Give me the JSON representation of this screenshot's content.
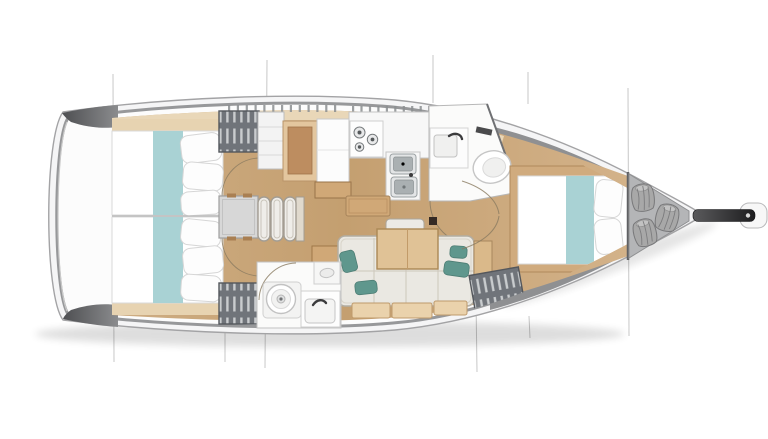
{
  "meta": {
    "title": "Sailboat interior layout floor plan, top view, bow pointing right",
    "figure_type": "boat-floor-plan",
    "orientation": "bow-right"
  },
  "palette": {
    "background": "#ffffff",
    "hull_fill": "#f5f5f6",
    "hull_outline": "#a3a3a5",
    "deck_white": "#fcfcfc",
    "gunwale": "#97989a",
    "stern_wedge_dark": "#515255",
    "stern_wedge_light": "#8b8c8e",
    "bow_band": "#8f9092",
    "floor_wood": "#c9a87c",
    "floor_wood_light": "#d8bc94",
    "deck_band": "#e9d7b8",
    "tick": "#8b8e90",
    "bed_white": "#ffffff",
    "bed_edge": "#d9d9d9",
    "bed_teal": "#a9d2d4",
    "pillow_white": "#fdfdfd",
    "pillow_edge": "#d6d6d6",
    "wardrobe_dark": "#70747a",
    "wardrobe_hanger": "#c9ccce",
    "wardrobe_edge": "#54575c",
    "engine_box": "#d7d7d7",
    "step_fill": "#efede9",
    "step_edge": "#a39d93",
    "wood_mid": "#d0a877",
    "wood_dark": "#a6835a",
    "wood_seat": "#bd8d60",
    "wood_seat_trim": "#e3c69e",
    "wood_table": "#e0c296",
    "wood_table_edge": "#ab8855",
    "wood_drawer": "#ead2ac",
    "wood_drawer_edge": "#bf9a6b",
    "cushion": "#eae8e2",
    "cushion_edge": "#b2ada2",
    "cushion_seam": "#ccc7bb",
    "teal_pillow": "#5f978d",
    "teal_pillow_edge": "#4d7d74",
    "appliance_white": "#f7f7f7",
    "appliance_edge": "#c5c5c5",
    "sink_metal": "#aab0b2",
    "sink_rim": "#e3e5e6",
    "burner_dark": "#55595b",
    "fixture_white": "#fbfbfa",
    "fixture_edge": "#c2c2c2",
    "faucet_dark": "#3b3b3d",
    "dark_fitting": "#352a24",
    "bulkhead_dark": "#606164",
    "locker_light": "#c8c9cb",
    "locker_dark": "#97989a",
    "bag_gray": "#a8a8a8",
    "bag_crease": "#7c7c7e",
    "bowsprit_dark": "#1d1d1f",
    "section_line": "#b5b5b5",
    "door_arc": "#8a7a60"
  },
  "rooms": [
    {
      "id": "aft-cabin-top",
      "label": "aft double cabin (top)"
    },
    {
      "id": "aft-cabin-bottom",
      "label": "aft double cabin (bottom)"
    },
    {
      "id": "companionway",
      "label": "companionway steps and engine box"
    },
    {
      "id": "nav-station",
      "label": "nav seat and chart table"
    },
    {
      "id": "galley",
      "label": "galley with stove and twin sinks"
    },
    {
      "id": "aft-head",
      "label": "aft head with toilet and washbasin"
    },
    {
      "id": "salon",
      "label": "salon with settee and folding table"
    },
    {
      "id": "forward-head",
      "label": "forward head with toilet and washbasin"
    },
    {
      "id": "forward-cabin",
      "label": "forward V-berth cabin"
    },
    {
      "id": "sail-locker",
      "label": "bow sail locker with gear bags"
    },
    {
      "id": "bow-fitting",
      "label": "bowsprit with anchor roller"
    }
  ],
  "section_lines": [
    {
      "x1": 113,
      "y1": 74,
      "x2": 114,
      "y2": 362
    },
    {
      "x1": 267,
      "y1": 60,
      "x2": 265,
      "y2": 368
    },
    {
      "x1": 225,
      "y1": 330,
      "x2": 225,
      "y2": 362
    },
    {
      "x1": 433,
      "y1": 55,
      "x2": 433,
      "y2": 103
    },
    {
      "x1": 476,
      "y1": 299,
      "x2": 477,
      "y2": 372
    },
    {
      "x1": 528,
      "y1": 72,
      "x2": 528,
      "y2": 104
    },
    {
      "x1": 529,
      "y1": 316,
      "x2": 530,
      "y2": 338
    },
    {
      "x1": 628,
      "y1": 88,
      "x2": 629,
      "y2": 336
    }
  ],
  "deck_ticks": [
    {
      "x1": 228,
      "x2": 334,
      "y": 105,
      "count": 13
    },
    {
      "x1": 352,
      "x2": 428,
      "y": 106,
      "count": 10
    }
  ],
  "sail_bags": [
    {
      "x": 643,
      "y": 198,
      "r": -6
    },
    {
      "x": 667,
      "y": 218,
      "r": 14
    },
    {
      "x": 645,
      "y": 233,
      "r": -14
    }
  ]
}
